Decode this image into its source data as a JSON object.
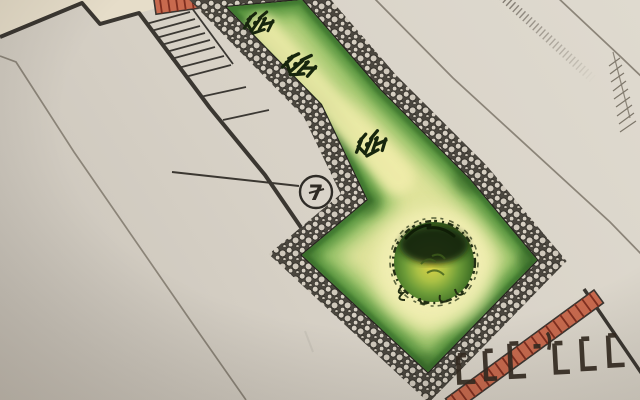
{
  "meta": {
    "description": "Photograph of a hand-drawn landscape / garden plan in colored pencil",
    "view": "plan drawing photographed at a slight angle"
  },
  "annotation": {
    "label": "7",
    "style": "circled number with leader line, crossed seven"
  },
  "sketch_marks": {
    "text_approx": "LLL-'LLL",
    "note": "dark hand-drawn L-shaped tally marks near bottom-right corner"
  },
  "plan_elements": {
    "lawn": "L-shaped lawn, yellow-green centre fading to green edges",
    "paving_border": "pebble / cobble mosaic band around lawn",
    "brick_edging": "red brick ladder edging at top and bottom-right",
    "stairs": "flight of steps with landings at upper left",
    "shrub_count": 3,
    "large_bush": 1,
    "boundary_lines": "pencil plot boundaries and survey tick line"
  },
  "palette": {
    "paper": "#d7d1c6",
    "paper_corner": "#e6ddc9",
    "ink": "#3b3731",
    "pencil_line": "#8b8478",
    "lawn_center": "#eeeaa6",
    "lawn_edge": "#5d9a40",
    "paving_dark": "#4a463e",
    "pebble": "#d6cfc2",
    "brick_red": "#c86a4e",
    "brick_joint": "#7e2e1f",
    "bush_dark": "#152608",
    "bush_center": "#d9d247",
    "mark_ink": "#352b21"
  }
}
